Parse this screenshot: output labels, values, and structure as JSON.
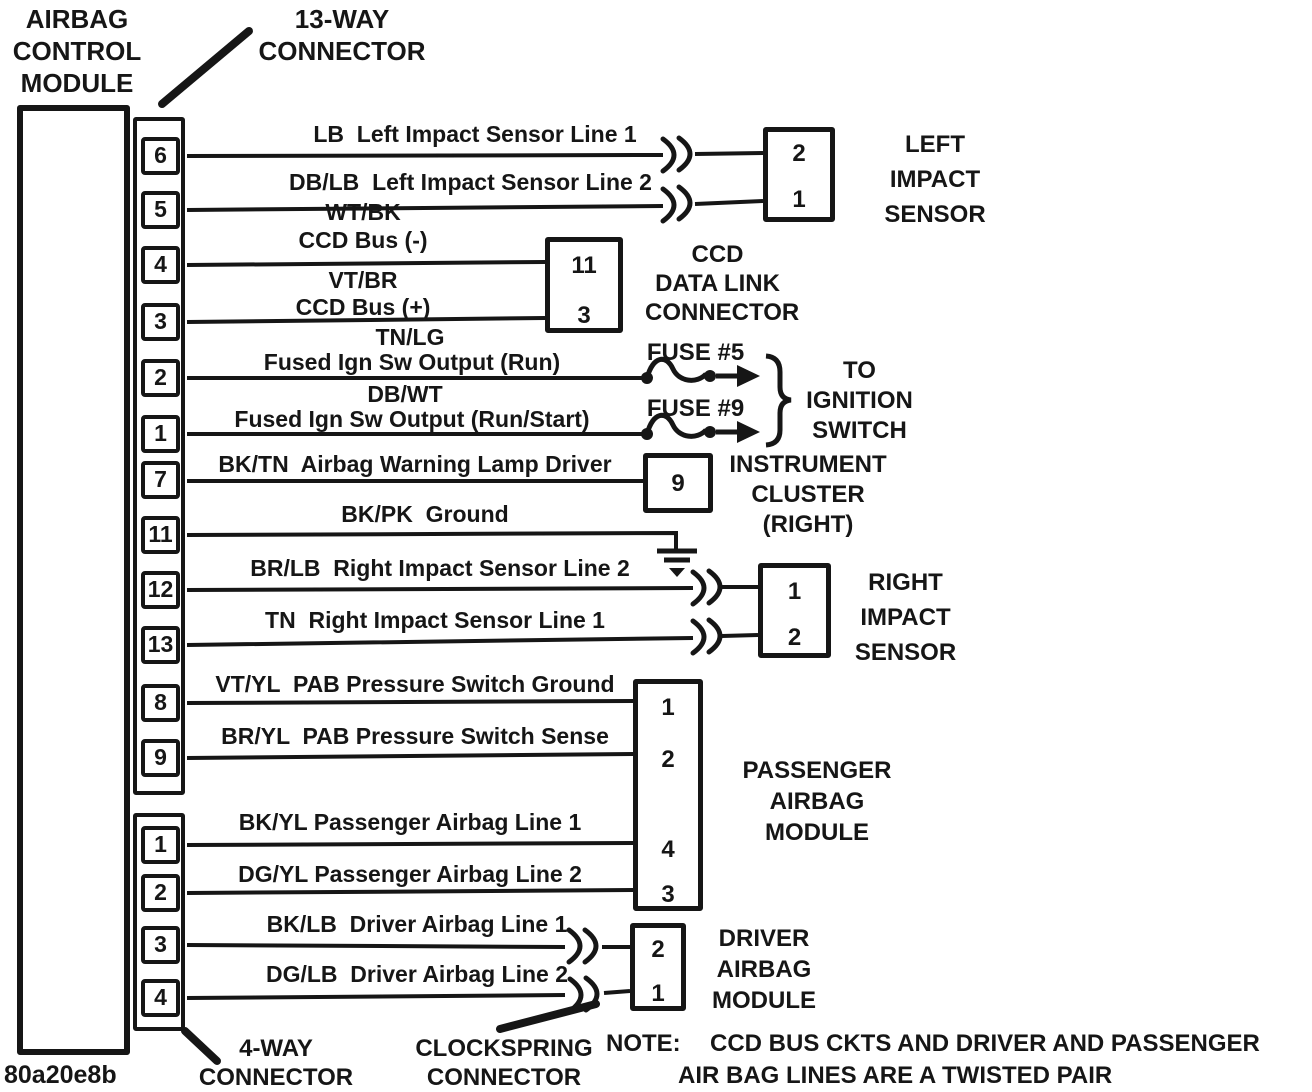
{
  "colors": {
    "ink": "#161616",
    "paper": "#ffffff"
  },
  "doc_code": "80a20e8b",
  "module": {
    "label": "AIRBAG\nCONTROL\nMODULE"
  },
  "connector13": {
    "label": "13-WAY\nCONNECTOR",
    "pins": [
      "6",
      "5",
      "4",
      "3",
      "2",
      "1",
      "7",
      "11",
      "12",
      "13",
      "8",
      "9"
    ]
  },
  "connector4": {
    "label": "4-WAY\nCONNECTOR",
    "pins": [
      "1",
      "2",
      "3",
      "4"
    ]
  },
  "clockspring": {
    "label": "CLOCKSPRING\nCONNECTOR"
  },
  "wires": [
    {
      "label": "LB  Left Impact Sensor Line 1"
    },
    {
      "label": "DB/LB  Left Impact Sensor Line 2"
    },
    {
      "code": "WT/BK",
      "label": "CCD Bus (-)"
    },
    {
      "code": "VT/BR",
      "label": "CCD Bus (+)"
    },
    {
      "code": "TN/LG",
      "label": "Fused Ign Sw Output (Run)"
    },
    {
      "code": "DB/WT",
      "label": "Fused Ign Sw Output (Run/Start)"
    },
    {
      "label": "BK/TN  Airbag Warning Lamp Driver"
    },
    {
      "label": "BK/PK  Ground"
    },
    {
      "label": "BR/LB  Right Impact Sensor Line 2"
    },
    {
      "label": "TN  Right Impact Sensor Line 1"
    },
    {
      "label": "VT/YL  PAB Pressure Switch Ground"
    },
    {
      "label": "BR/YL  PAB Pressure Switch Sense"
    },
    {
      "label": "BK/YL Passenger Airbag Line 1"
    },
    {
      "label": "DG/YL Passenger Airbag Line 2"
    },
    {
      "label": "BK/LB  Driver Airbag Line 1"
    },
    {
      "label": "DG/LB  Driver Airbag Line 2"
    }
  ],
  "components": {
    "left_impact": {
      "name": "LEFT\nIMPACT\nSENSOR",
      "pins": [
        "2",
        "1"
      ]
    },
    "ccd": {
      "name": "CCD\nDATA LINK\nCONNECTOR",
      "pins": [
        "11",
        "3"
      ]
    },
    "ignition": {
      "name": "TO\nIGNITION\nSWITCH",
      "fuses": [
        "FUSE #5",
        "FUSE #9"
      ]
    },
    "cluster": {
      "name": "INSTRUMENT\nCLUSTER\n(RIGHT)",
      "pins": [
        "9"
      ]
    },
    "right_impact": {
      "name": "RIGHT\nIMPACT\nSENSOR",
      "pins": [
        "1",
        "2"
      ]
    },
    "passenger_airbag": {
      "name": "PASSENGER\nAIRBAG\nMODULE",
      "pins": [
        "1",
        "2",
        "4",
        "3"
      ]
    },
    "driver_airbag": {
      "name": "DRIVER\nAIRBAG\nMODULE",
      "pins": [
        "2",
        "1"
      ]
    }
  },
  "note": {
    "prefix": "NOTE:",
    "line1": "CCD BUS CKTS AND DRIVER AND PASSENGER",
    "line2": "AIR BAG LINES ARE A TWISTED PAIR"
  }
}
